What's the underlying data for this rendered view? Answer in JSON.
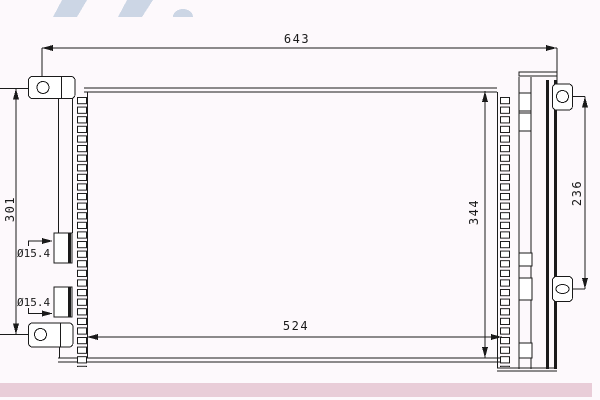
{
  "page": {
    "colors": {
      "background": "#fdf9fc",
      "line": "#1a1a1a",
      "watermark": "#ccd6e5",
      "footer_band": "#e9cdd8"
    }
  },
  "drawing": {
    "type": "technical-drawing",
    "subject": "condenser-front-view",
    "dimensions": {
      "overall_width": "643",
      "left_bracket_span": "301",
      "core_width": "524",
      "core_height": "344",
      "right_bracket_span": "236",
      "top_fitting_diameter": "Ø15.4",
      "bottom_fitting_diameter": "Ø15.4"
    }
  }
}
